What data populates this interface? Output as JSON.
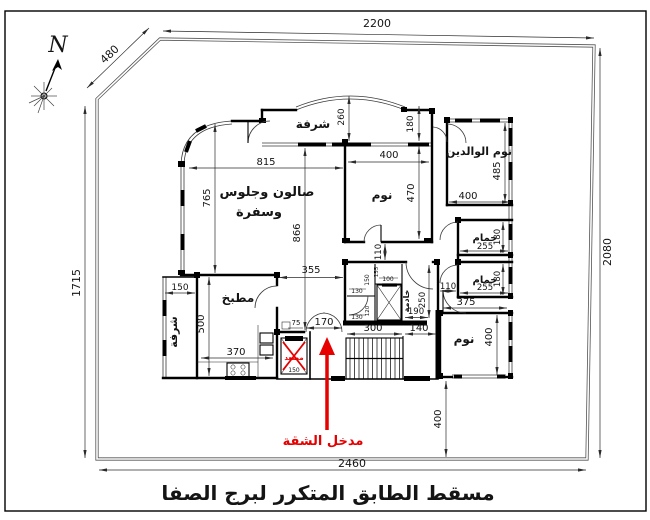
{
  "colors": {
    "accent_red": "#e60000",
    "wall_black": "#000000",
    "dim_gray": "#2b2b2b"
  },
  "title": {
    "text": "مسقط الطابق المتكرر لبرج الصفا"
  },
  "compass": {
    "north_label": "N"
  },
  "entrance": {
    "note": "مدخل الشقة"
  },
  "rooms": {
    "balcony_top": "شرفة",
    "salon_line1": "صالون وجلوس",
    "salon_line2": "وسفرة",
    "bedroom_top": "نوم",
    "parents_bedroom": "نوم الوالدين",
    "bathroom_upper": "حمام",
    "bathroom_lower": "حمام",
    "kitchen": "مطبخ",
    "balcony_left": "شرفة",
    "maid_room": "خادمة",
    "bedroom_right": "نوم",
    "elevator": "مصعد"
  },
  "site_dims": {
    "top": "2200",
    "chamfer": "480",
    "left": "1715",
    "right": "2080",
    "bottom": "2460"
  },
  "dims": {
    "balcony_top_depth": "260",
    "salon_width": "815",
    "salon_left_height": "765",
    "salon_total_height": "866",
    "bedroom_top_width": "400",
    "bedroom_top_height": "470",
    "entry_recess": "180",
    "parents_height": "485",
    "parents_width": "400",
    "bath_upper_width": "255",
    "bath_upper_depth": "180",
    "bath_lower_width": "255",
    "bath_lower_depth": "180",
    "hall_width": "110",
    "corridor_width": "110",
    "lobby_width": "355",
    "balcony_left_width": "150",
    "kitchen_height": "500",
    "kitchen_width": "370",
    "entry_jamb": "75",
    "entrance_door_width": "170",
    "lobby_elevator_size": "150",
    "stairs_width": "300",
    "landing_width": "140",
    "maid_height": "250",
    "maid_width": "190",
    "wc1_width": "130",
    "wc1_height": "150",
    "duct_width": "100",
    "duct_height": "155",
    "wc2_width": "130",
    "wc2_height": "120",
    "bedroom_right_width": "375",
    "bedroom_right_height": "400",
    "rear_setback": "400"
  }
}
